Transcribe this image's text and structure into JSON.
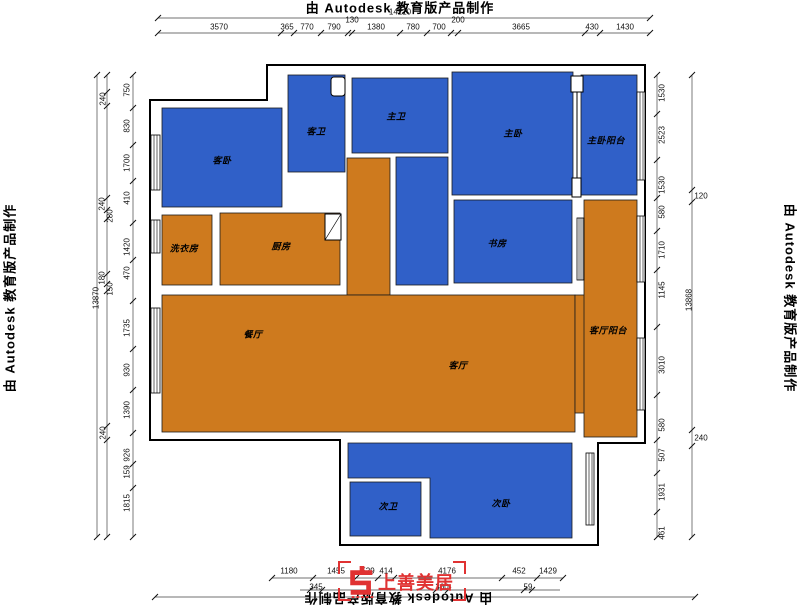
{
  "watermark": {
    "text": "由 Autodesk 教育版产品制作"
  },
  "logo": {
    "text": "上善美居"
  },
  "colors": {
    "bedroom_blue": "#3060C8",
    "living_orange": "#CE7A1E",
    "wall_black": "#000000",
    "dim_text": "#111111",
    "logo_red": "#E03232"
  },
  "rooms": [
    {
      "id": "guest-bedroom",
      "label": "客卧",
      "x": 222,
      "y": 160
    },
    {
      "id": "guest-bathroom",
      "label": "客卫",
      "x": 316,
      "y": 131
    },
    {
      "id": "master-bathroom",
      "label": "主卫",
      "x": 396,
      "y": 116
    },
    {
      "id": "master-bedroom",
      "label": "主卧",
      "x": 513,
      "y": 133
    },
    {
      "id": "master-balcony",
      "label": "主卧阳台",
      "x": 606,
      "y": 140
    },
    {
      "id": "laundry-room",
      "label": "洗衣房",
      "x": 184,
      "y": 248
    },
    {
      "id": "kitchen",
      "label": "厨房",
      "x": 281,
      "y": 246
    },
    {
      "id": "study",
      "label": "书房",
      "x": 497,
      "y": 243
    },
    {
      "id": "dining-room",
      "label": "餐厅",
      "x": 253,
      "y": 334
    },
    {
      "id": "living-room",
      "label": "客厅",
      "x": 458,
      "y": 365
    },
    {
      "id": "living-balcony",
      "label": "客厅阳台",
      "x": 608,
      "y": 330
    },
    {
      "id": "second-bathroom",
      "label": "次卫",
      "x": 388,
      "y": 506
    },
    {
      "id": "second-bedroom",
      "label": "次卧",
      "x": 501,
      "y": 503
    }
  ],
  "dimensions": {
    "top": [
      {
        "t": "14210",
        "x": 400,
        "y": 12
      },
      {
        "t": "3570",
        "x": 219,
        "y": 27
      },
      {
        "t": "365",
        "x": 287,
        "y": 27
      },
      {
        "t": "770",
        "x": 307,
        "y": 27
      },
      {
        "t": "790",
        "x": 334,
        "y": 27
      },
      {
        "t": "130",
        "x": 352,
        "y": 20
      },
      {
        "t": "1380",
        "x": 376,
        "y": 27
      },
      {
        "t": "780",
        "x": 413,
        "y": 27
      },
      {
        "t": "700",
        "x": 439,
        "y": 27
      },
      {
        "t": "200",
        "x": 458,
        "y": 20
      },
      {
        "t": "3665",
        "x": 521,
        "y": 27
      },
      {
        "t": "430",
        "x": 592,
        "y": 27
      },
      {
        "t": "1430",
        "x": 625,
        "y": 27
      }
    ],
    "left": [
      {
        "t": "750",
        "x": 127,
        "y": 90,
        "r": 1
      },
      {
        "t": "830",
        "x": 127,
        "y": 126,
        "r": 1
      },
      {
        "t": "1700",
        "x": 127,
        "y": 163,
        "r": 1
      },
      {
        "t": "410",
        "x": 127,
        "y": 198,
        "r": 1
      },
      {
        "t": "1420",
        "x": 127,
        "y": 247,
        "r": 1
      },
      {
        "t": "470",
        "x": 127,
        "y": 273,
        "r": 1
      },
      {
        "t": "1735",
        "x": 127,
        "y": 328,
        "r": 1
      },
      {
        "t": "930",
        "x": 127,
        "y": 370,
        "r": 1
      },
      {
        "t": "1390",
        "x": 127,
        "y": 410,
        "r": 1
      },
      {
        "t": "926",
        "x": 127,
        "y": 455,
        "r": 1
      },
      {
        "t": "159",
        "x": 127,
        "y": 472,
        "r": 1
      },
      {
        "t": "1815",
        "x": 127,
        "y": 503,
        "r": 1
      },
      {
        "t": "240",
        "x": 103,
        "y": 99,
        "r": 1
      },
      {
        "t": "240",
        "x": 102,
        "y": 204,
        "r": 1
      },
      {
        "t": "280",
        "x": 110,
        "y": 216,
        "r": 1
      },
      {
        "t": "180",
        "x": 102,
        "y": 278,
        "r": 1
      },
      {
        "t": "150",
        "x": 110,
        "y": 289,
        "r": 1
      },
      {
        "t": "240",
        "x": 103,
        "y": 433,
        "r": 1
      },
      {
        "t": "13870",
        "x": 96,
        "y": 298,
        "r": 1
      }
    ],
    "right": [
      {
        "t": "1530",
        "x": 662,
        "y": 93,
        "r": 1
      },
      {
        "t": "2523",
        "x": 662,
        "y": 135,
        "r": 1
      },
      {
        "t": "1530",
        "x": 662,
        "y": 185,
        "r": 1
      },
      {
        "t": "580",
        "x": 662,
        "y": 212,
        "r": 1
      },
      {
        "t": "1710",
        "x": 662,
        "y": 250,
        "r": 1
      },
      {
        "t": "1145",
        "x": 662,
        "y": 290,
        "r": 1
      },
      {
        "t": "3010",
        "x": 662,
        "y": 365,
        "r": 1
      },
      {
        "t": "580",
        "x": 662,
        "y": 425,
        "r": 1
      },
      {
        "t": "507",
        "x": 662,
        "y": 455,
        "r": 1
      },
      {
        "t": "1931",
        "x": 662,
        "y": 492,
        "r": 1
      },
      {
        "t": "461",
        "x": 662,
        "y": 533,
        "r": 1
      },
      {
        "t": "120",
        "x": 701,
        "y": 196
      },
      {
        "t": "13868",
        "x": 689,
        "y": 300,
        "r": 1
      },
      {
        "t": "240",
        "x": 701,
        "y": 438
      }
    ],
    "bottom": [
      {
        "t": "1180",
        "x": 289,
        "y": 571
      },
      {
        "t": "1455",
        "x": 336,
        "y": 571
      },
      {
        "t": "529",
        "x": 368,
        "y": 571
      },
      {
        "t": "414",
        "x": 386,
        "y": 571
      },
      {
        "t": "4176",
        "x": 447,
        "y": 571
      },
      {
        "t": "452",
        "x": 519,
        "y": 571
      },
      {
        "t": "1429",
        "x": 548,
        "y": 571
      },
      {
        "t": "345",
        "x": 316,
        "y": 587
      },
      {
        "t": "360",
        "x": 442,
        "y": 587
      },
      {
        "t": "59",
        "x": 528,
        "y": 587
      }
    ]
  }
}
